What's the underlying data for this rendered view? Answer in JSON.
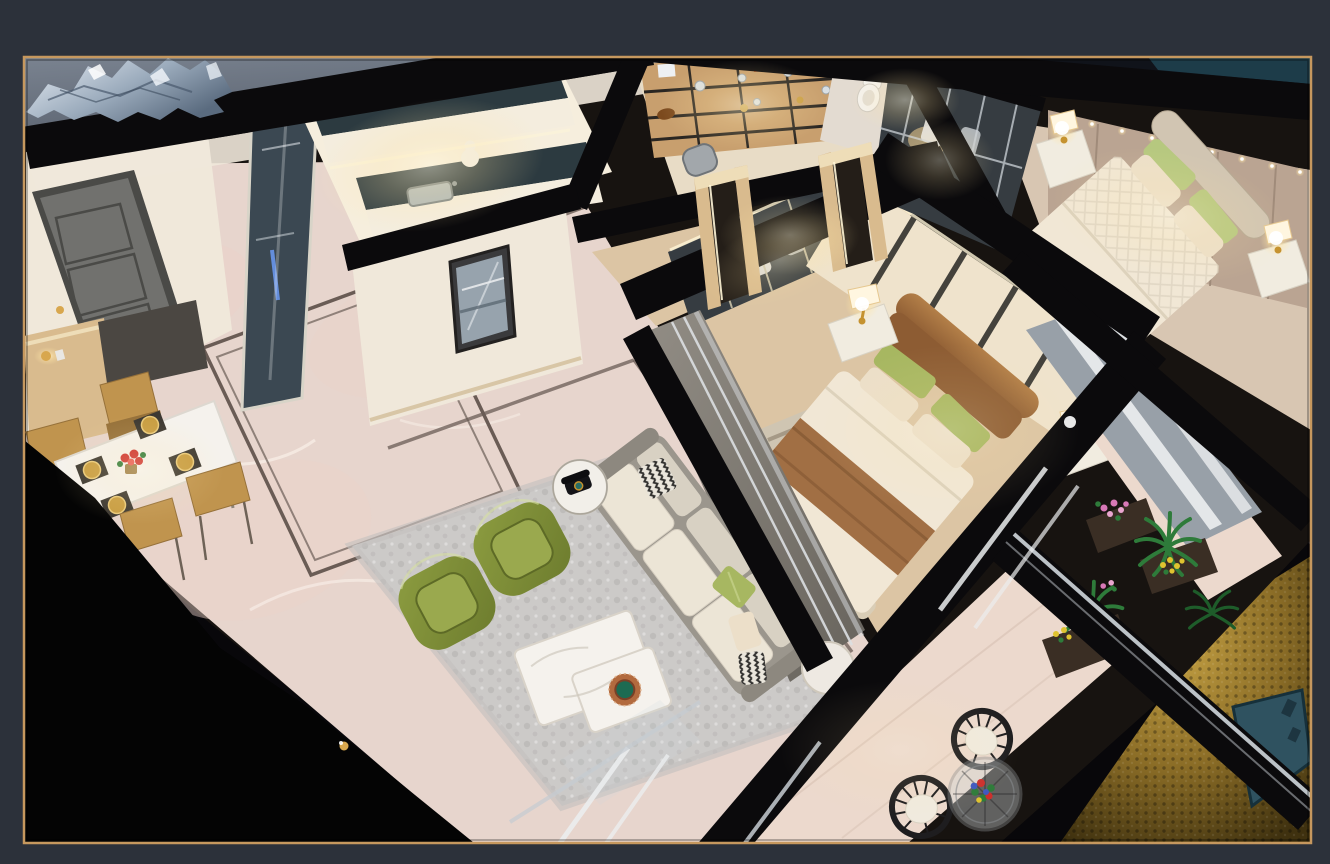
{
  "image": {
    "kind": "photograph",
    "subject": "cutaway miniature apartment scale model viewed from above",
    "frame_style": "dark charcoal mat with thin gold border"
  },
  "scene": {
    "rooms": [
      {
        "name": "entry"
      },
      {
        "name": "kitchen"
      },
      {
        "name": "dining-area"
      },
      {
        "name": "hallway"
      },
      {
        "name": "study-shelves"
      },
      {
        "name": "bathroom"
      },
      {
        "name": "master-bedroom"
      },
      {
        "name": "second-bedroom"
      },
      {
        "name": "walk-in-closet"
      },
      {
        "name": "living-room"
      },
      {
        "name": "side-balcony"
      },
      {
        "name": "patio-balcony"
      }
    ],
    "objects": [
      "silver-foil",
      "entry-door",
      "sideboard",
      "dining-table",
      "gold-dining-chairs",
      "gold-place-settings",
      "red-flower-centerpiece",
      "display-shelf-unit",
      "toilet",
      "glass-wardrobe",
      "master-bed",
      "bedside-lamps",
      "nightstands",
      "second-bed",
      "padded-headboard-wall",
      "sofa",
      "throw-pillows",
      "olive-armchairs",
      "marble-coffee-table",
      "telephone-side-table",
      "area-rug",
      "floor-inlay-border",
      "sliding-glass-doors",
      "potted-plants",
      "wicker-chairs",
      "glass-patio-table",
      "flower-bouquet",
      "hammered-gold-surface",
      "teal-plaque"
    ]
  },
  "palette": {
    "frame_bg": "#2c313a",
    "frame_border": "#c6985e",
    "photo_bg": "#08070a",
    "top_strip": "#10131a",
    "bg_gray_hi": "#7a8390",
    "bg_gray_dark": "#434a57",
    "bg_teal": "#1d3c49",
    "backdrop_dark": "#23212a",
    "wall_black": "#0b0a0c",
    "wall_hi": "#2b272b",
    "wedge_black": "#040404",
    "foil_light": "#e8eef5",
    "foil_mid": "#9cacbd",
    "foil_dark": "#5a6b7f",
    "marble": "#e7d5cd",
    "marble_vein": "#f7ece5",
    "blush": "#ecd2c9",
    "inlay": "#6a5c55",
    "cream_wall": "#f0e8da",
    "cream_hi": "#fbf6ec",
    "baseboard": "#d8c6a6",
    "door_gray": "#71716e",
    "door_dark": "#4a4a47",
    "oak": "#d9bb8e",
    "oak_light": "#eeddb8",
    "wood_floor": "#dcc5a4",
    "rug_gray": "#cccac8",
    "rug_mottle": "#b3b0ae",
    "rug_stripe_a": "#9b8f7c",
    "rug_stripe_b": "#bcae94",
    "counter_dark": "#2c3a40",
    "cabinet_white": "#f4edde",
    "glass_pane": "#cdd6dc",
    "glass_teal": "#3b4852",
    "mullion_white": "#eceeef",
    "silver_edge": "#c6ccd2",
    "shelf_wood": "#c89f6e",
    "shelf_dark": "#2a2622",
    "silver_item": "#d9dfe3",
    "orange_box": "#d2622d",
    "horse_brown": "#7c4a1e",
    "leather_a": "#938e86",
    "leather_b": "#67635c",
    "chrome": "#dcdfe2",
    "sofa_frame": "#9b968d",
    "sofa_back": "#d8d1c3",
    "sofa_seat": "#ece5d6",
    "bw_dark": "#32312f",
    "bw_light": "#eae6dc",
    "pillow_green": "#a7b761",
    "pillow_cream": "#ecdfc9",
    "chair_olive": "#8c9c40",
    "chair_olive_dark": "#6d7c2e",
    "chair_olive_seat": "#9aa94e",
    "table_white": "#f5f2ed",
    "table_shadow": "#cfc8bc",
    "plate_copper": "#b26a3e",
    "plate_green": "#1d6b52",
    "phone_black": "#141418",
    "gold_chair": "#c0944e",
    "gold_chair_dark": "#96713a",
    "gold_plate": "#c89d42",
    "mat_dark": "#3c3832",
    "flower_red": "#cd2f2c",
    "leaf_green": "#2f7a38",
    "bed_cream": "#f1e7d5",
    "bed_fold": "#d9cdb6",
    "runner_brown": "#a16f44",
    "runner_dark": "#7e5330",
    "hb_brown": "#8d5c33",
    "hb_brown_hi": "#b37f48",
    "panel_cream": "#efe3cc",
    "slat_dark": "#44423c",
    "taupe_wall": "#baa492",
    "taupe_seam": "#9c8776",
    "bed2_frame": "#d1c5b2",
    "quilt_line": "#ddd3c0",
    "nightstand_white": "#f1ece0",
    "nightstand_dark": "#33302c",
    "glow_core": "#fff6d8",
    "glow_mid": "#ffe5a6",
    "lamp_gold": "#c5922f",
    "wardrobe_glass": "#363c41",
    "wardrobe_mullion": "#c9c2a9",
    "cloth_white": "#e9e7e3",
    "cloth_gray": "#c2c7cb",
    "vase_blue": "#7e93a3",
    "glow_warm": "#f3cf92",
    "balcony_tile": "#ecd9cd",
    "tile_line": "#d3bcae",
    "plant_green": "#2e7b3a",
    "plant_dark": "#1e5c2a",
    "planter_dark": "#3a2e24",
    "flower_pink": "#d778b6",
    "flower_pink_lt": "#eaa6d0",
    "flower_yellow": "#dfc330",
    "flower_blue": "#3f58c0",
    "wicker_dark": "#1e1d1f",
    "cushion_white": "#f0eade",
    "glass_table": "#cfd5d7",
    "ring_gray": "#86898c",
    "gold_a": "#c8a445",
    "gold_b": "#8a6c26",
    "gold_c": "#3f310f",
    "remote_teal": "#2f5260",
    "remote_dark": "#1d3540",
    "niche_gold": "#d8a74e"
  }
}
